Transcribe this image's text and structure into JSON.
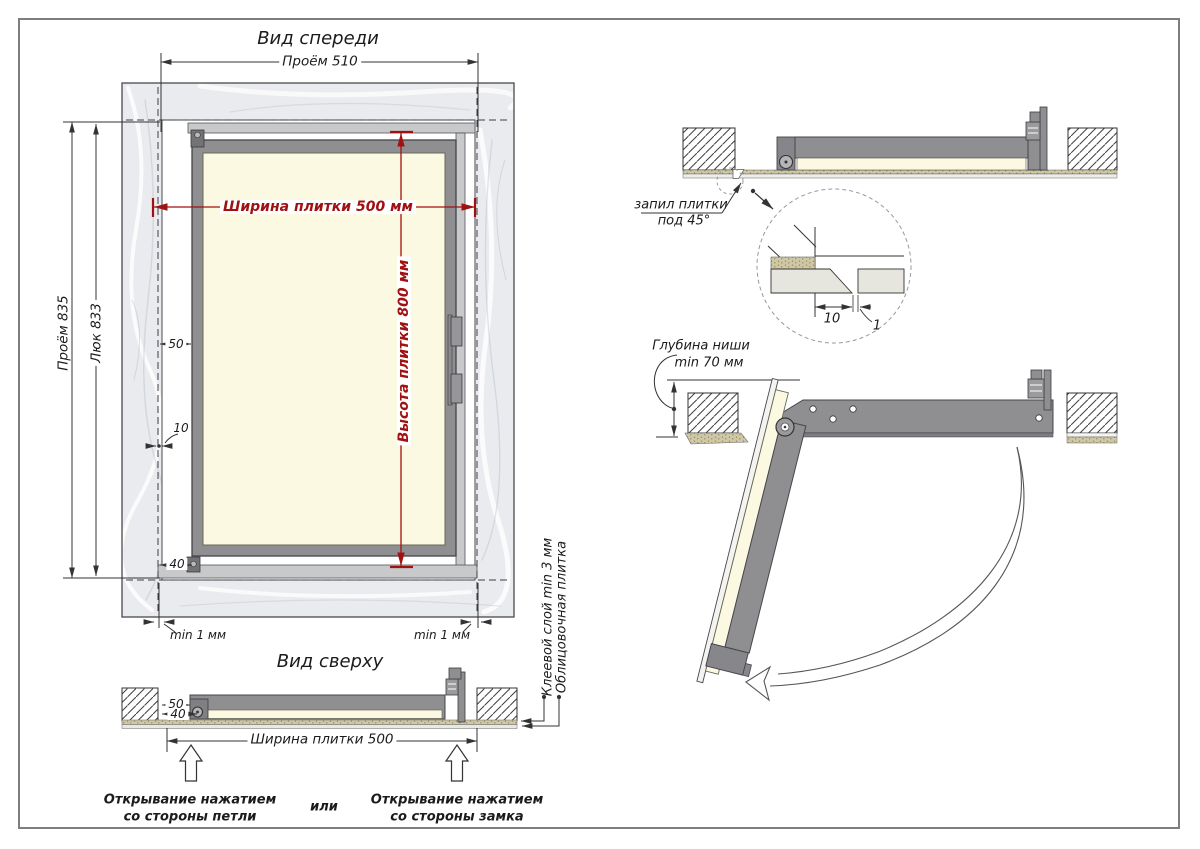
{
  "front_view": {
    "title": "Вид спереди",
    "opening_width": "Проём 510",
    "opening_height": "Проём 835",
    "hatch_height": "Люк 833",
    "tile_width": "Ширина плитки 500 мм",
    "tile_height": "Высота плитки 800 мм",
    "offset_50": "50",
    "offset_10": "10",
    "offset_40": "40",
    "gap_left": "min 1 мм",
    "gap_right": "min 1 мм"
  },
  "top_view": {
    "title": "Вид сверху",
    "offset_50": "50",
    "offset_40": "40",
    "tile_width": "Ширина плитки 500",
    "press_hinge_1": "Открывание нажатием",
    "press_hinge_2": "со стороны петли",
    "or": "или",
    "press_lock_1": "Открывание нажатием",
    "press_lock_2": "со стороны замка",
    "adhesive_label": "Клеевой слой min 3 мм",
    "tile_label": "Облицовочная плитка"
  },
  "section_closed": {
    "cut_label_1": "запил плитки",
    "cut_label_2": "под 45°",
    "detail_width": "10",
    "detail_gap": "1"
  },
  "section_open": {
    "depth_label_1": "Глубина ниши",
    "depth_label_2": "min 70 мм"
  },
  "colors": {
    "dimension_red": "#a01212",
    "tile_cream": "#fcf9e3",
    "frame_gray": "#8f8f91",
    "wall_marble": "#eaebee",
    "line_dark": "#333333"
  }
}
